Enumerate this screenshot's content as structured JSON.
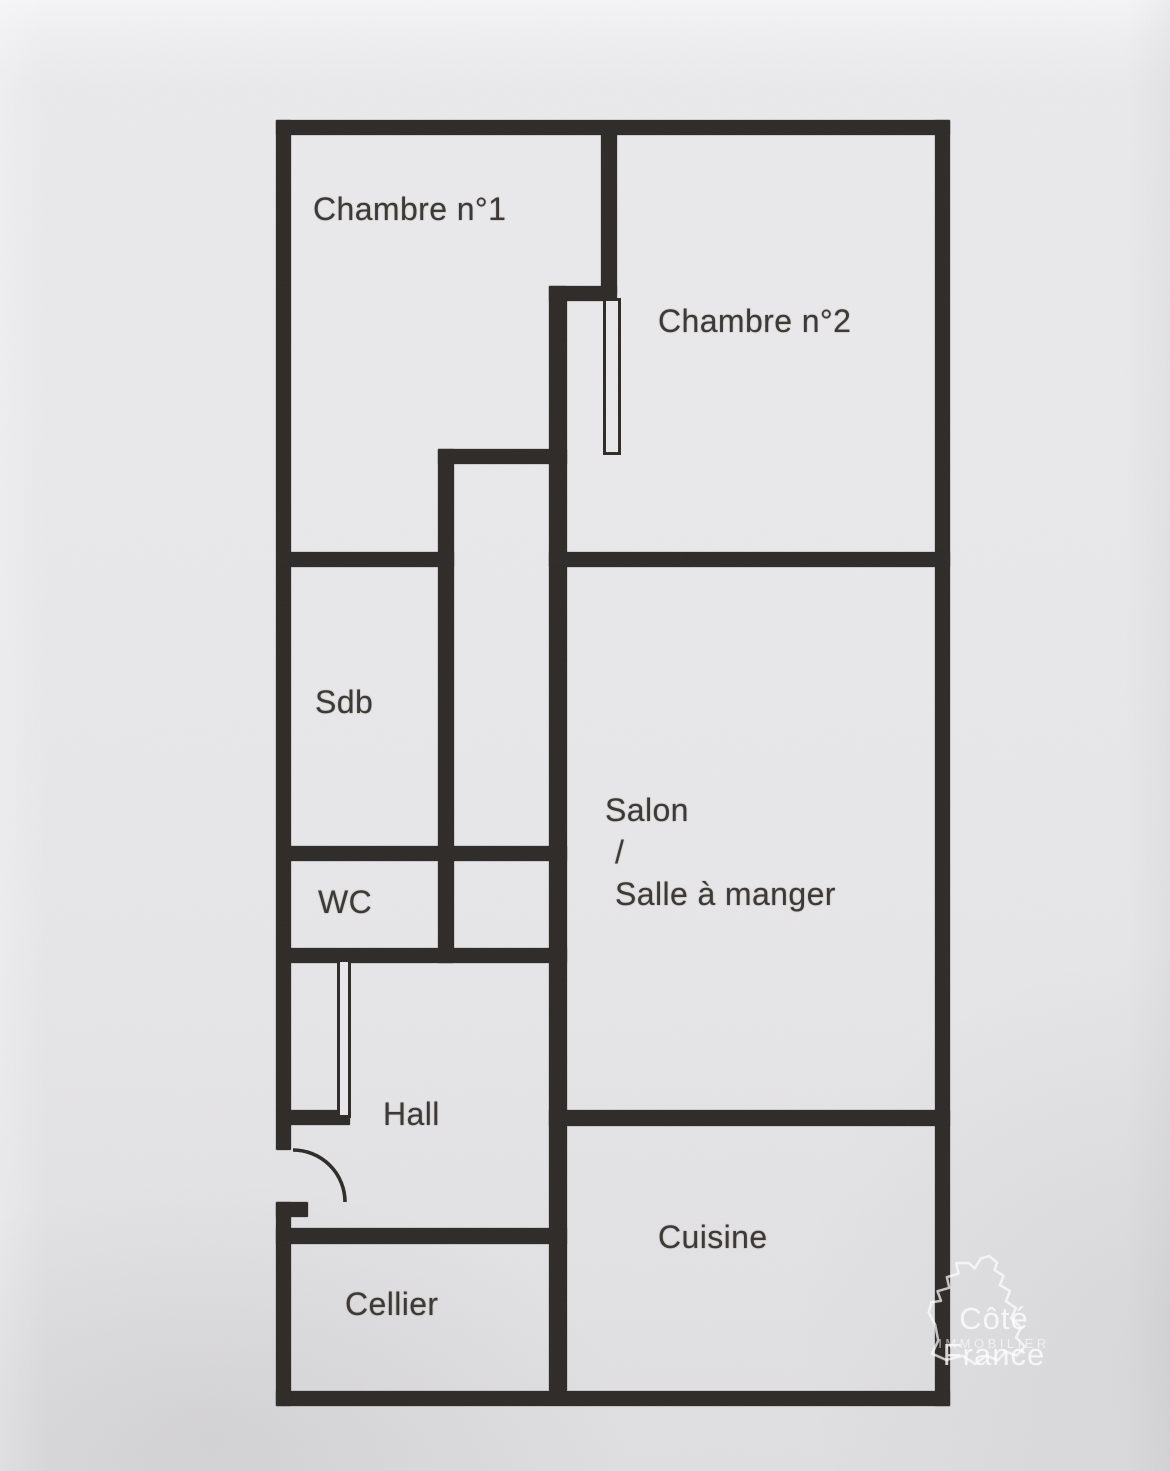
{
  "plan": {
    "rooms": {
      "chambre1": {
        "label": "Chambre n°1"
      },
      "chambre2": {
        "label": "Chambre n°2"
      },
      "sdb": {
        "label": "Sdb"
      },
      "wc": {
        "label": "WC"
      },
      "salon": {
        "lines": [
          "Salon",
          "/",
          "Salle à manger"
        ]
      },
      "hall": {
        "label": "Hall"
      },
      "cuisine": {
        "label": "Cuisine"
      },
      "cellier": {
        "label": "Cellier"
      }
    }
  },
  "watermark": {
    "brand": "Côté France",
    "tagline": "IMMOBILIER"
  },
  "colors": {
    "paper": "#e9e8ea",
    "wall": "#2d2a27",
    "label_ink": "#3a3632",
    "watermark_text": "rgba(255,255,255,0.78)"
  }
}
